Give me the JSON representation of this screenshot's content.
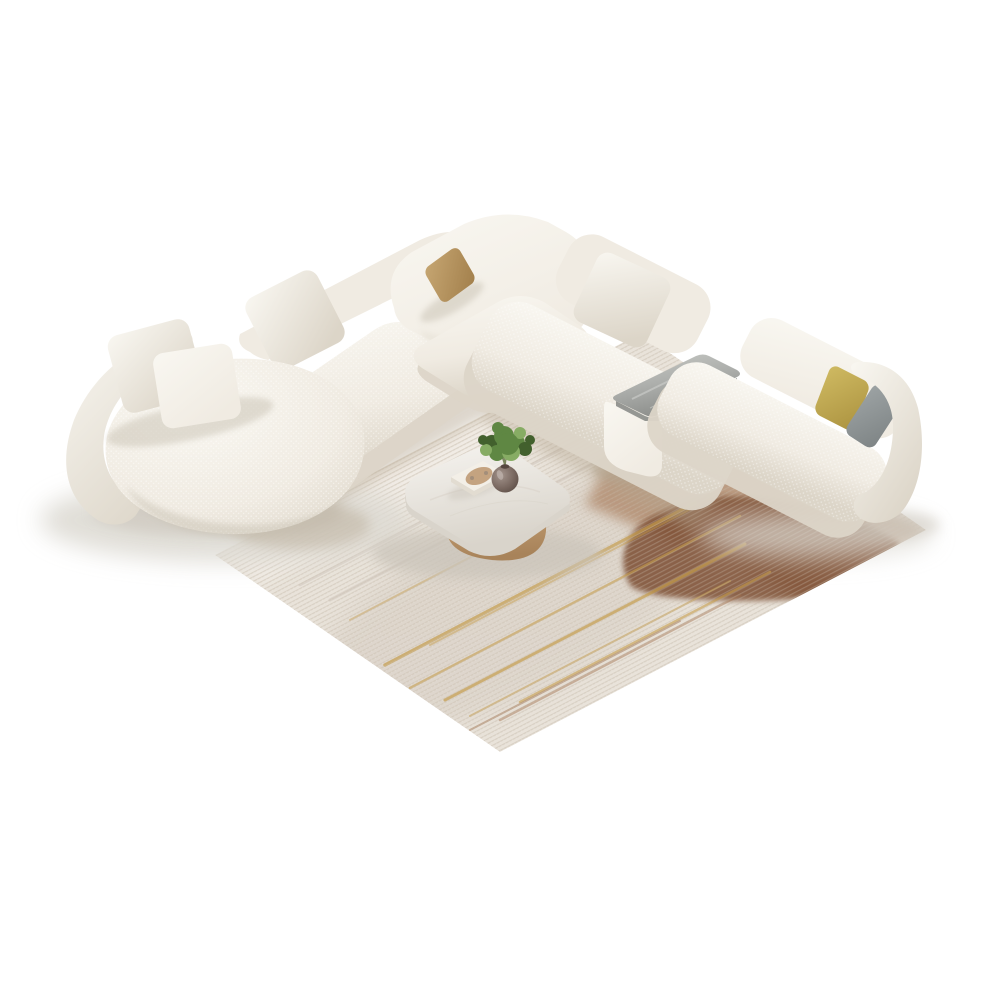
{
  "scene": {
    "background": "#ffffff"
  },
  "sofa": {
    "fabric_light": "#f9f7f1",
    "fabric_mid": "#f0ebe2",
    "fabric_shadow": "#dcd5c8",
    "fabric_deep": "#c8c1b2",
    "pillow_tan": "#c6a672",
    "pillow_tan_shadow": "#a27f4b",
    "pillow_yellow": "#cfba62",
    "pillow_yellow_shadow": "#ac9340",
    "pillow_gray": "#9da3a4",
    "pillow_gray_shadow": "#7e8485",
    "tray_top": "#aeb0ad",
    "tray_vein": "#c9cbc7",
    "tray_side": "#8b8d8a"
  },
  "rug": {
    "base": "#e9e3da",
    "weave": "#cfc5b7",
    "light_zone": "#f3eee7",
    "taupe_zone": "#cec4b9",
    "rust": "#a06f4b",
    "rust_dark": "#7b4d30",
    "gold": "#c49c4d"
  },
  "table": {
    "top": "#f6f4f0",
    "top_edge": "#d9d4cb",
    "wood": "#c9a478",
    "wood_dark": "#a8835a",
    "book_cover": "#f3efe7",
    "book_pages": "#e2dcd1",
    "book_art": "#bf9a74",
    "vase": "#7b6a62",
    "vase_dark": "#55463f",
    "vase_light": "#a3948c",
    "plant_green": "#5f8743",
    "plant_green_dark": "#42602d",
    "plant_green_light": "#87ac64",
    "stem": "#6d7a4e"
  },
  "shadow": {
    "floor": "#dddad3",
    "contact": "#cac4ba",
    "rug_contact": "#b4a58f"
  }
}
